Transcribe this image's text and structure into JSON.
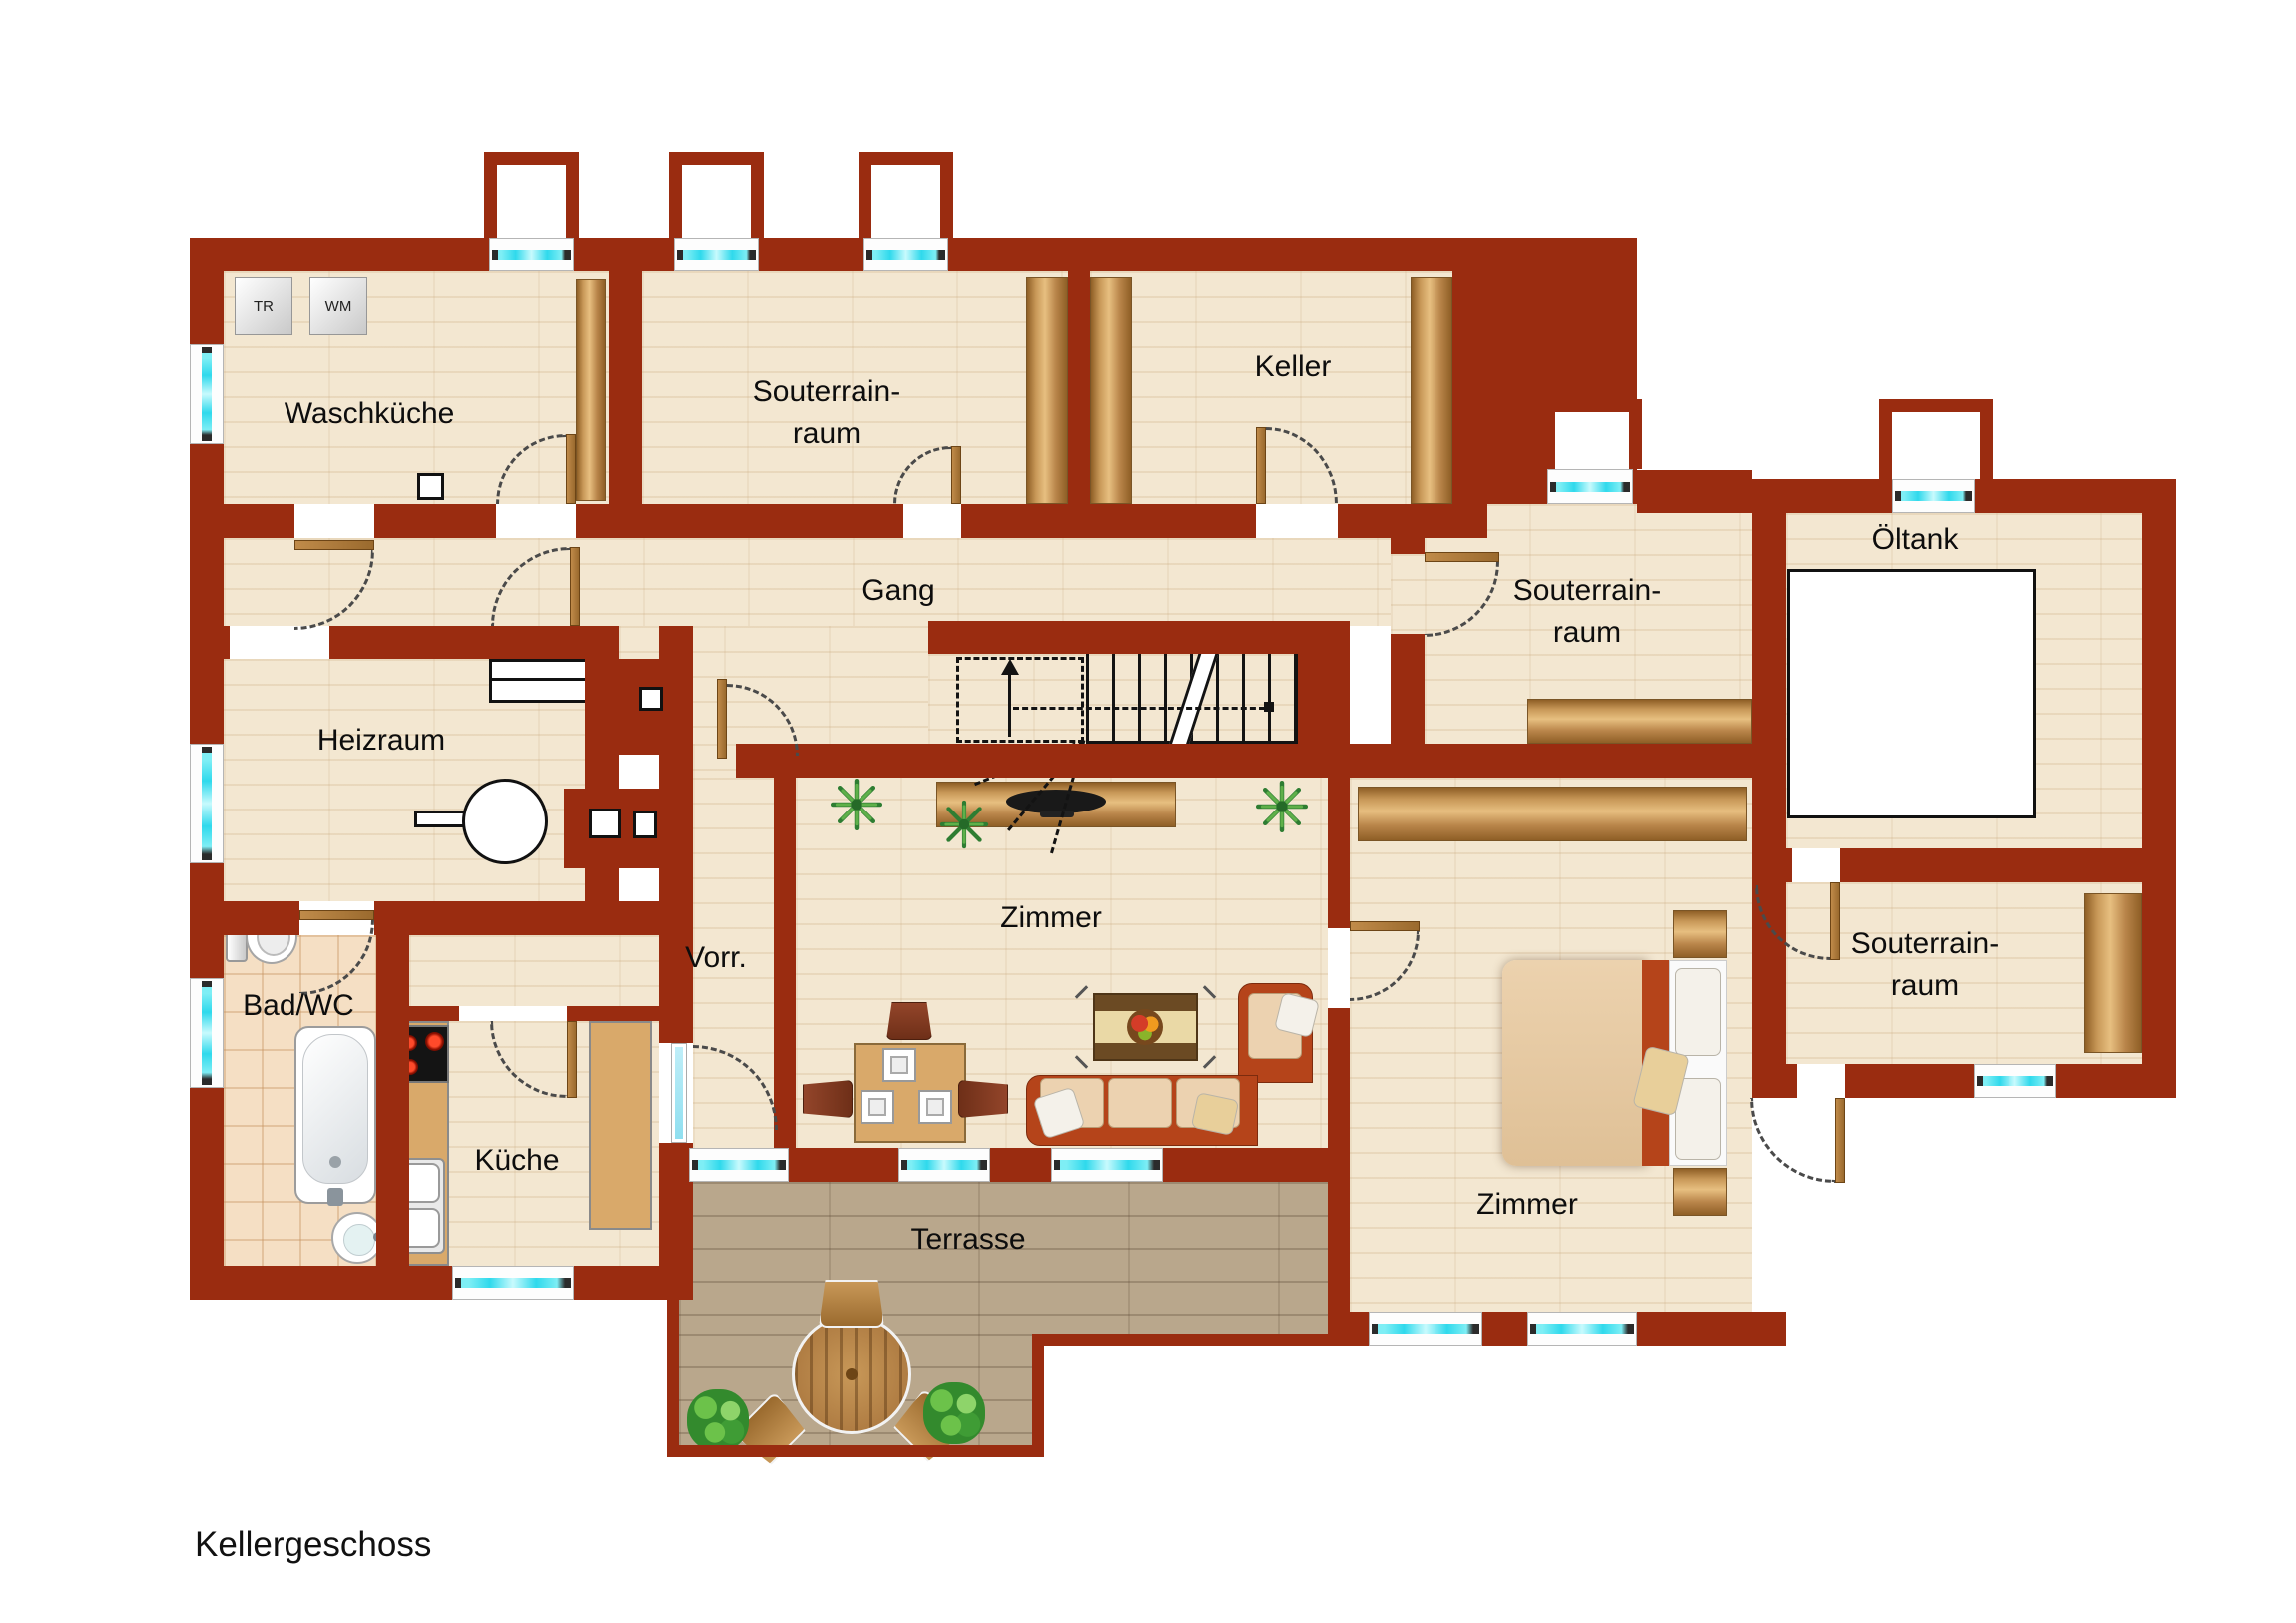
{
  "title": "Kellergeschoss",
  "colors": {
    "wall": "#9a2c10",
    "floor": "#f3e7d1",
    "tile": "#f5dfc4",
    "terrace": "#b9a78c",
    "glass": "#2fd9ec",
    "door": "#b07c3f",
    "wood": "#c89858",
    "sofa": "#b5441a",
    "cushion": "#ecd2b0",
    "outline": "#141414"
  },
  "rooms": [
    {
      "id": "waschkueche",
      "label": "Waschküche"
    },
    {
      "id": "souterrainraum-oben",
      "lines": [
        "Souterrain-",
        "raum"
      ]
    },
    {
      "id": "keller",
      "label": "Keller"
    },
    {
      "id": "gang",
      "label": "Gang"
    },
    {
      "id": "heizraum",
      "label": "Heizraum"
    },
    {
      "id": "souterrainraum-mitte",
      "lines": [
        "Souterrain-",
        "raum"
      ]
    },
    {
      "id": "oeltank",
      "label": "Öltank"
    },
    {
      "id": "bad-wc",
      "label": "Bad/WC"
    },
    {
      "id": "vorraum",
      "label": "Vorr."
    },
    {
      "id": "zimmer-mitte",
      "label": "Zimmer"
    },
    {
      "id": "kueche",
      "label": "Küche"
    },
    {
      "id": "terrasse",
      "label": "Terrasse"
    },
    {
      "id": "zimmer-rechts",
      "label": "Zimmer"
    },
    {
      "id": "souterrainraum-unten",
      "lines": [
        "Souterrain-",
        "raum"
      ]
    }
  ],
  "appliances": {
    "dryer": "TR",
    "washer": "WM"
  }
}
